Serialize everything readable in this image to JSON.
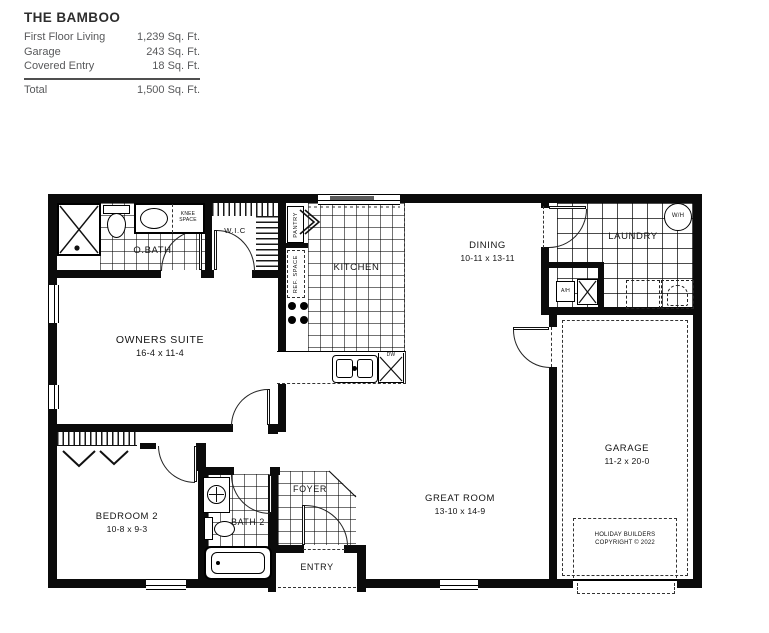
{
  "title_block": {
    "plan_name": "THE BAMBOO",
    "areas": [
      {
        "label": "First Floor Living",
        "value": "1,239 Sq. Ft."
      },
      {
        "label": "Garage",
        "value": "243 Sq. Ft."
      },
      {
        "label": "Covered Entry",
        "value": "18 Sq. Ft."
      }
    ],
    "total_label": "Total",
    "total_value": "1,500 Sq. Ft."
  },
  "rooms": {
    "obath": {
      "name": "O.BATH"
    },
    "wic": {
      "name": "W.I.C"
    },
    "kitchen": {
      "name": "KITCHEN"
    },
    "dining": {
      "name": "DINING",
      "dims": "10-11 x 13-11"
    },
    "laundry": {
      "name": "LAUNDRY"
    },
    "owners_suite": {
      "name": "OWNERS SUITE",
      "dims": "16-4 x 11-4"
    },
    "bedroom2": {
      "name": "BEDROOM 2",
      "dims": "10-8 x 9-3"
    },
    "bath2": {
      "name": "BATH 2"
    },
    "foyer": {
      "name": "FOYER"
    },
    "entry": {
      "name": "ENTRY"
    },
    "great_room": {
      "name": "GREAT ROOM",
      "dims": "13-10 x 14-9"
    },
    "garage": {
      "name": "GARAGE",
      "dims": "11-2 x 20-0"
    }
  },
  "fixtures": {
    "knee_space_line1": "KNEE",
    "knee_space_line2": "SPACE",
    "pantry": "PANTRY",
    "ref_space": "REF. SPACE",
    "dishwasher": "DW",
    "water_heater": "W/H",
    "air_handler": "A/H"
  },
  "copyright": {
    "line1": "HOLIDAY BUILDERS",
    "line2": "COPYRIGHT © 2022"
  },
  "colors": {
    "wall": "#0b0b0b",
    "text_gray": "#58595b",
    "line": "#222222"
  }
}
